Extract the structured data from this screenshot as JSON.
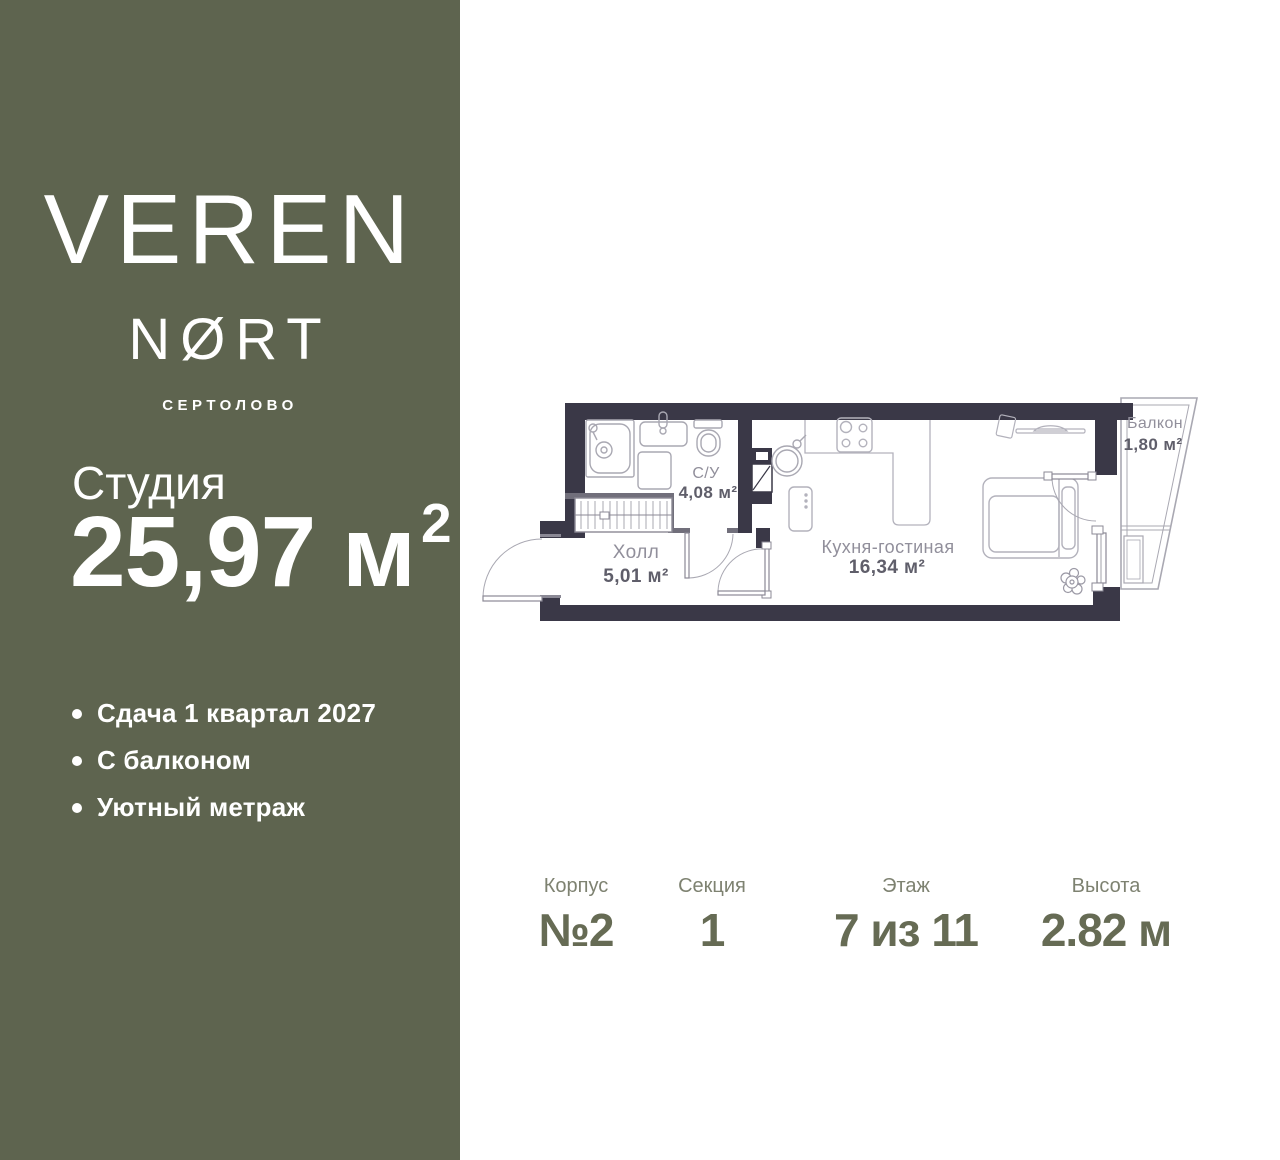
{
  "colors": {
    "sidebar_bg": "#5e644f",
    "canvas_bg": "#ffffff",
    "wall_dark": "#3a3847",
    "wall_light": "#716f7b",
    "fixture_line": "#a9a8b2",
    "door_line": "#8b8995",
    "room_name_text": "#918f9b",
    "room_area_text": "#5f5e6a",
    "detail_label_text": "#7e8271",
    "detail_value_text": "#666b54",
    "sidebar_text": "#ffffff"
  },
  "brand": {
    "name_top": "VEREN",
    "name_bottom": "NØRT",
    "location": "СЕРТОЛОВО"
  },
  "unit": {
    "type": "Студия",
    "area_value": "25,97",
    "area_unit": " м",
    "area_exponent": "2"
  },
  "features": [
    {
      "text": "Сдача 1 квартал 2027"
    },
    {
      "text": "С балконом"
    },
    {
      "text": "Уютный метраж"
    }
  ],
  "floorplan": {
    "rooms": [
      {
        "name": "С/У",
        "area": "4,08 м²"
      },
      {
        "name": "Холл",
        "area": "5,01 м²"
      },
      {
        "name": "Кухня-гостиная",
        "area": "16,34 м²"
      },
      {
        "name": "Балкон",
        "area": "1,80 м²"
      }
    ]
  },
  "details": [
    {
      "label": "Корпус",
      "value": "№2"
    },
    {
      "label": "Секция",
      "value": "1"
    },
    {
      "label": "Этаж",
      "value": "7 из 11"
    },
    {
      "label": "Высота",
      "value": "2.82 м"
    }
  ]
}
